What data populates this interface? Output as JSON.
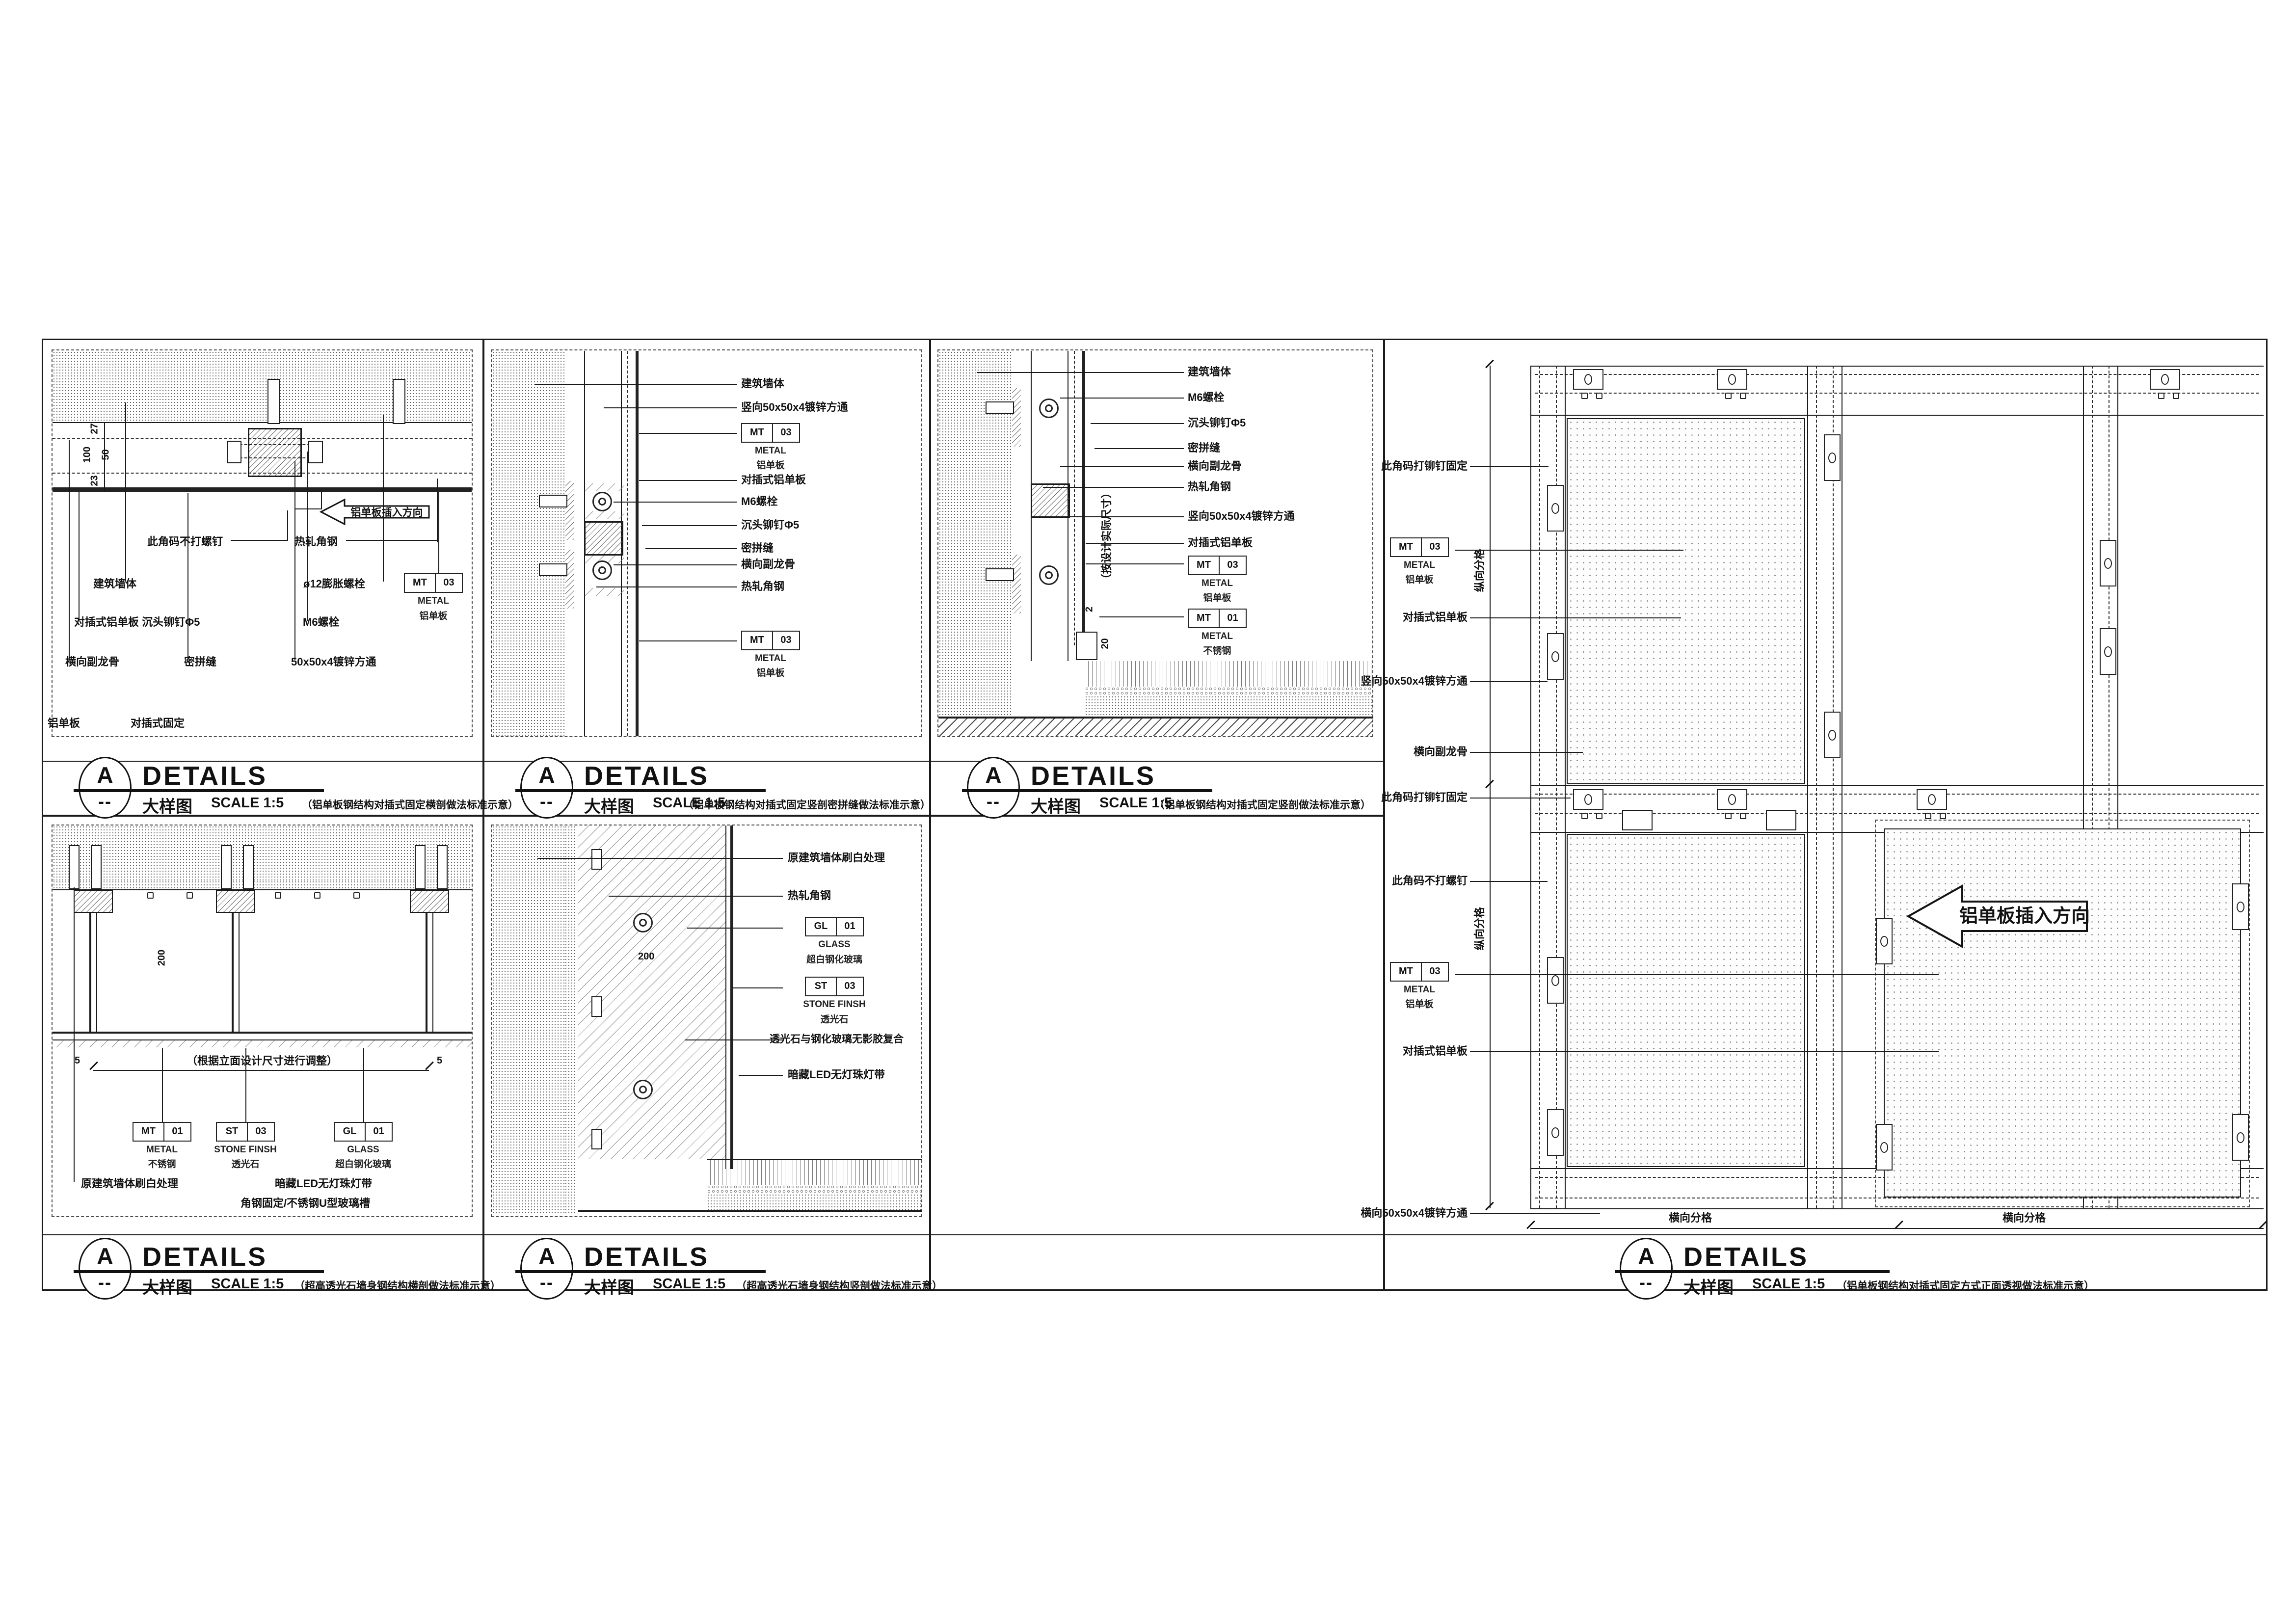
{
  "document": {
    "marker_letter": "A",
    "marker_dash": "--",
    "heading": "DETAILS",
    "view_label": "大样图",
    "scale_label": "SCALE  1:5"
  },
  "tags": {
    "mt03": {
      "c1": "MT",
      "c2": "03",
      "line1": "METAL",
      "line2": "铝单板"
    },
    "mt01": {
      "c1": "MT",
      "c2": "01",
      "line1": "METAL",
      "line2": "不锈钢"
    },
    "st03": {
      "c1": "ST",
      "c2": "03",
      "line1": "STONE FINSH",
      "line2": "透光石"
    },
    "gl01": {
      "c1": "GL",
      "c2": "01",
      "line1": "GLASS",
      "line2": "超白钢化玻璃"
    }
  },
  "p1": {
    "note": "（铝单板钢结构对插式固定横剖做法标准示意）",
    "labels": {
      "corner_clip": "此角码不打螺钉",
      "angle_steel": "热轧角钢",
      "wall": "建筑墙体",
      "anchor": "ø12膨胀螺栓",
      "panel_rivet": "对插式铝单板 沉头铆钉Φ5",
      "m6": "M6螺栓",
      "sub_keel": "横向副龙骨",
      "seam": "密拼缝",
      "tube": "50x50x4镀锌方通",
      "corner1": "铝单板",
      "corner2": "对插式固定"
    },
    "dims": {
      "d27": "27",
      "d100": "100",
      "d50": "50",
      "d23": "23"
    },
    "arrow": "铝单板插入方向"
  },
  "p2": {
    "note": "（铝单板钢结构对插式固定竖剖密拼缝做法标准示意）",
    "labels": {
      "wall": "建筑墙体",
      "v_tube": "竖向50x50x4镀锌方通",
      "panel": "对插式铝单板",
      "m6": "M6螺栓",
      "rivet": "沉头铆钉Φ5",
      "seam": "密拼缝",
      "sub_keel": "横向副龙骨",
      "angle_steel": "热轧角钢"
    }
  },
  "p3": {
    "note": "（铝单板钢结构对插式固定竖剖做法标准示意）",
    "labels": {
      "wall": "建筑墙体",
      "m6": "M6螺栓",
      "rivet": "沉头铆钉Φ5",
      "seam": "密拼缝",
      "sub_keel": "横向副龙骨",
      "angle_steel": "热轧角钢",
      "v_tube": "竖向50x50x4镀锌方通",
      "panel": "对插式铝单板"
    },
    "vnote": "（按设计实际尺寸）",
    "dims": {
      "d2": "2",
      "d20": "20"
    }
  },
  "p4": {
    "note": "（铝单板钢结构对插式固定方式正面透视做法标准示意）",
    "labels": {
      "clip_rivet_1": "此角码打铆钉固定",
      "panel_1": "对插式铝单板",
      "v_tube": "竖向50x50x4镀锌方通",
      "sub_keel": "横向副龙骨",
      "clip_rivet_2": "此角码打铆钉固定",
      "clip_noscrew": "此角码不打螺钉",
      "panel_2": "对插式铝单板",
      "h_tube": "横向50x50x4镀锌方通"
    },
    "dims": {
      "v1": "纵向分格",
      "v2": "纵向分格",
      "h1": "横向分格",
      "h2": "横向分格"
    },
    "arrow": "铝单板插入方向"
  },
  "p5": {
    "note": "（超高透光石墙身钢结构横剖做法标准示意）",
    "labels": {
      "wall_white": "原建筑墙体刷白处理",
      "led": "暗藏LED无灯珠灯带",
      "u_channel": "角钢固定/不锈钢U型玻璃槽"
    },
    "dims": {
      "d200": "200",
      "d5a": "5",
      "d5b": "5",
      "adjust": "（根据立面设计尺寸进行调整）"
    }
  },
  "p6": {
    "note": "（超高透光石墙身钢结构竖剖做法标准示意）",
    "labels": {
      "wall_white": "原建筑墙体刷白处理",
      "angle_steel": "热轧角钢",
      "laminate": "透光石与钢化玻璃无影胶复合",
      "led": "暗藏LED无灯珠灯带"
    },
    "dims": {
      "d200": "200"
    }
  }
}
